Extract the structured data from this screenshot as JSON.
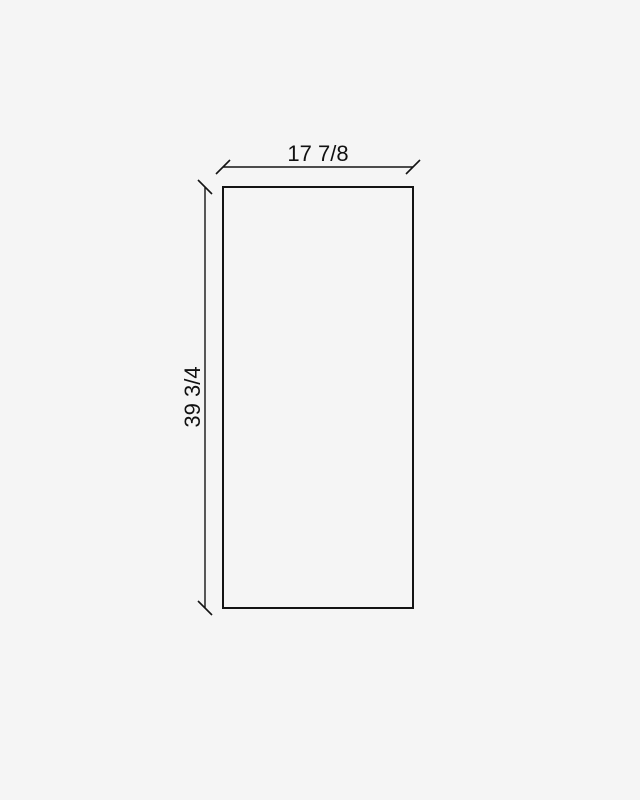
{
  "canvas": {
    "background_color": "#f5f5f5",
    "line_color": "#141414",
    "text_color": "#111111"
  },
  "diagram": {
    "title": "panel-dimension-drawing",
    "width_label": "17 7/8",
    "height_label": "39 3/4"
  }
}
